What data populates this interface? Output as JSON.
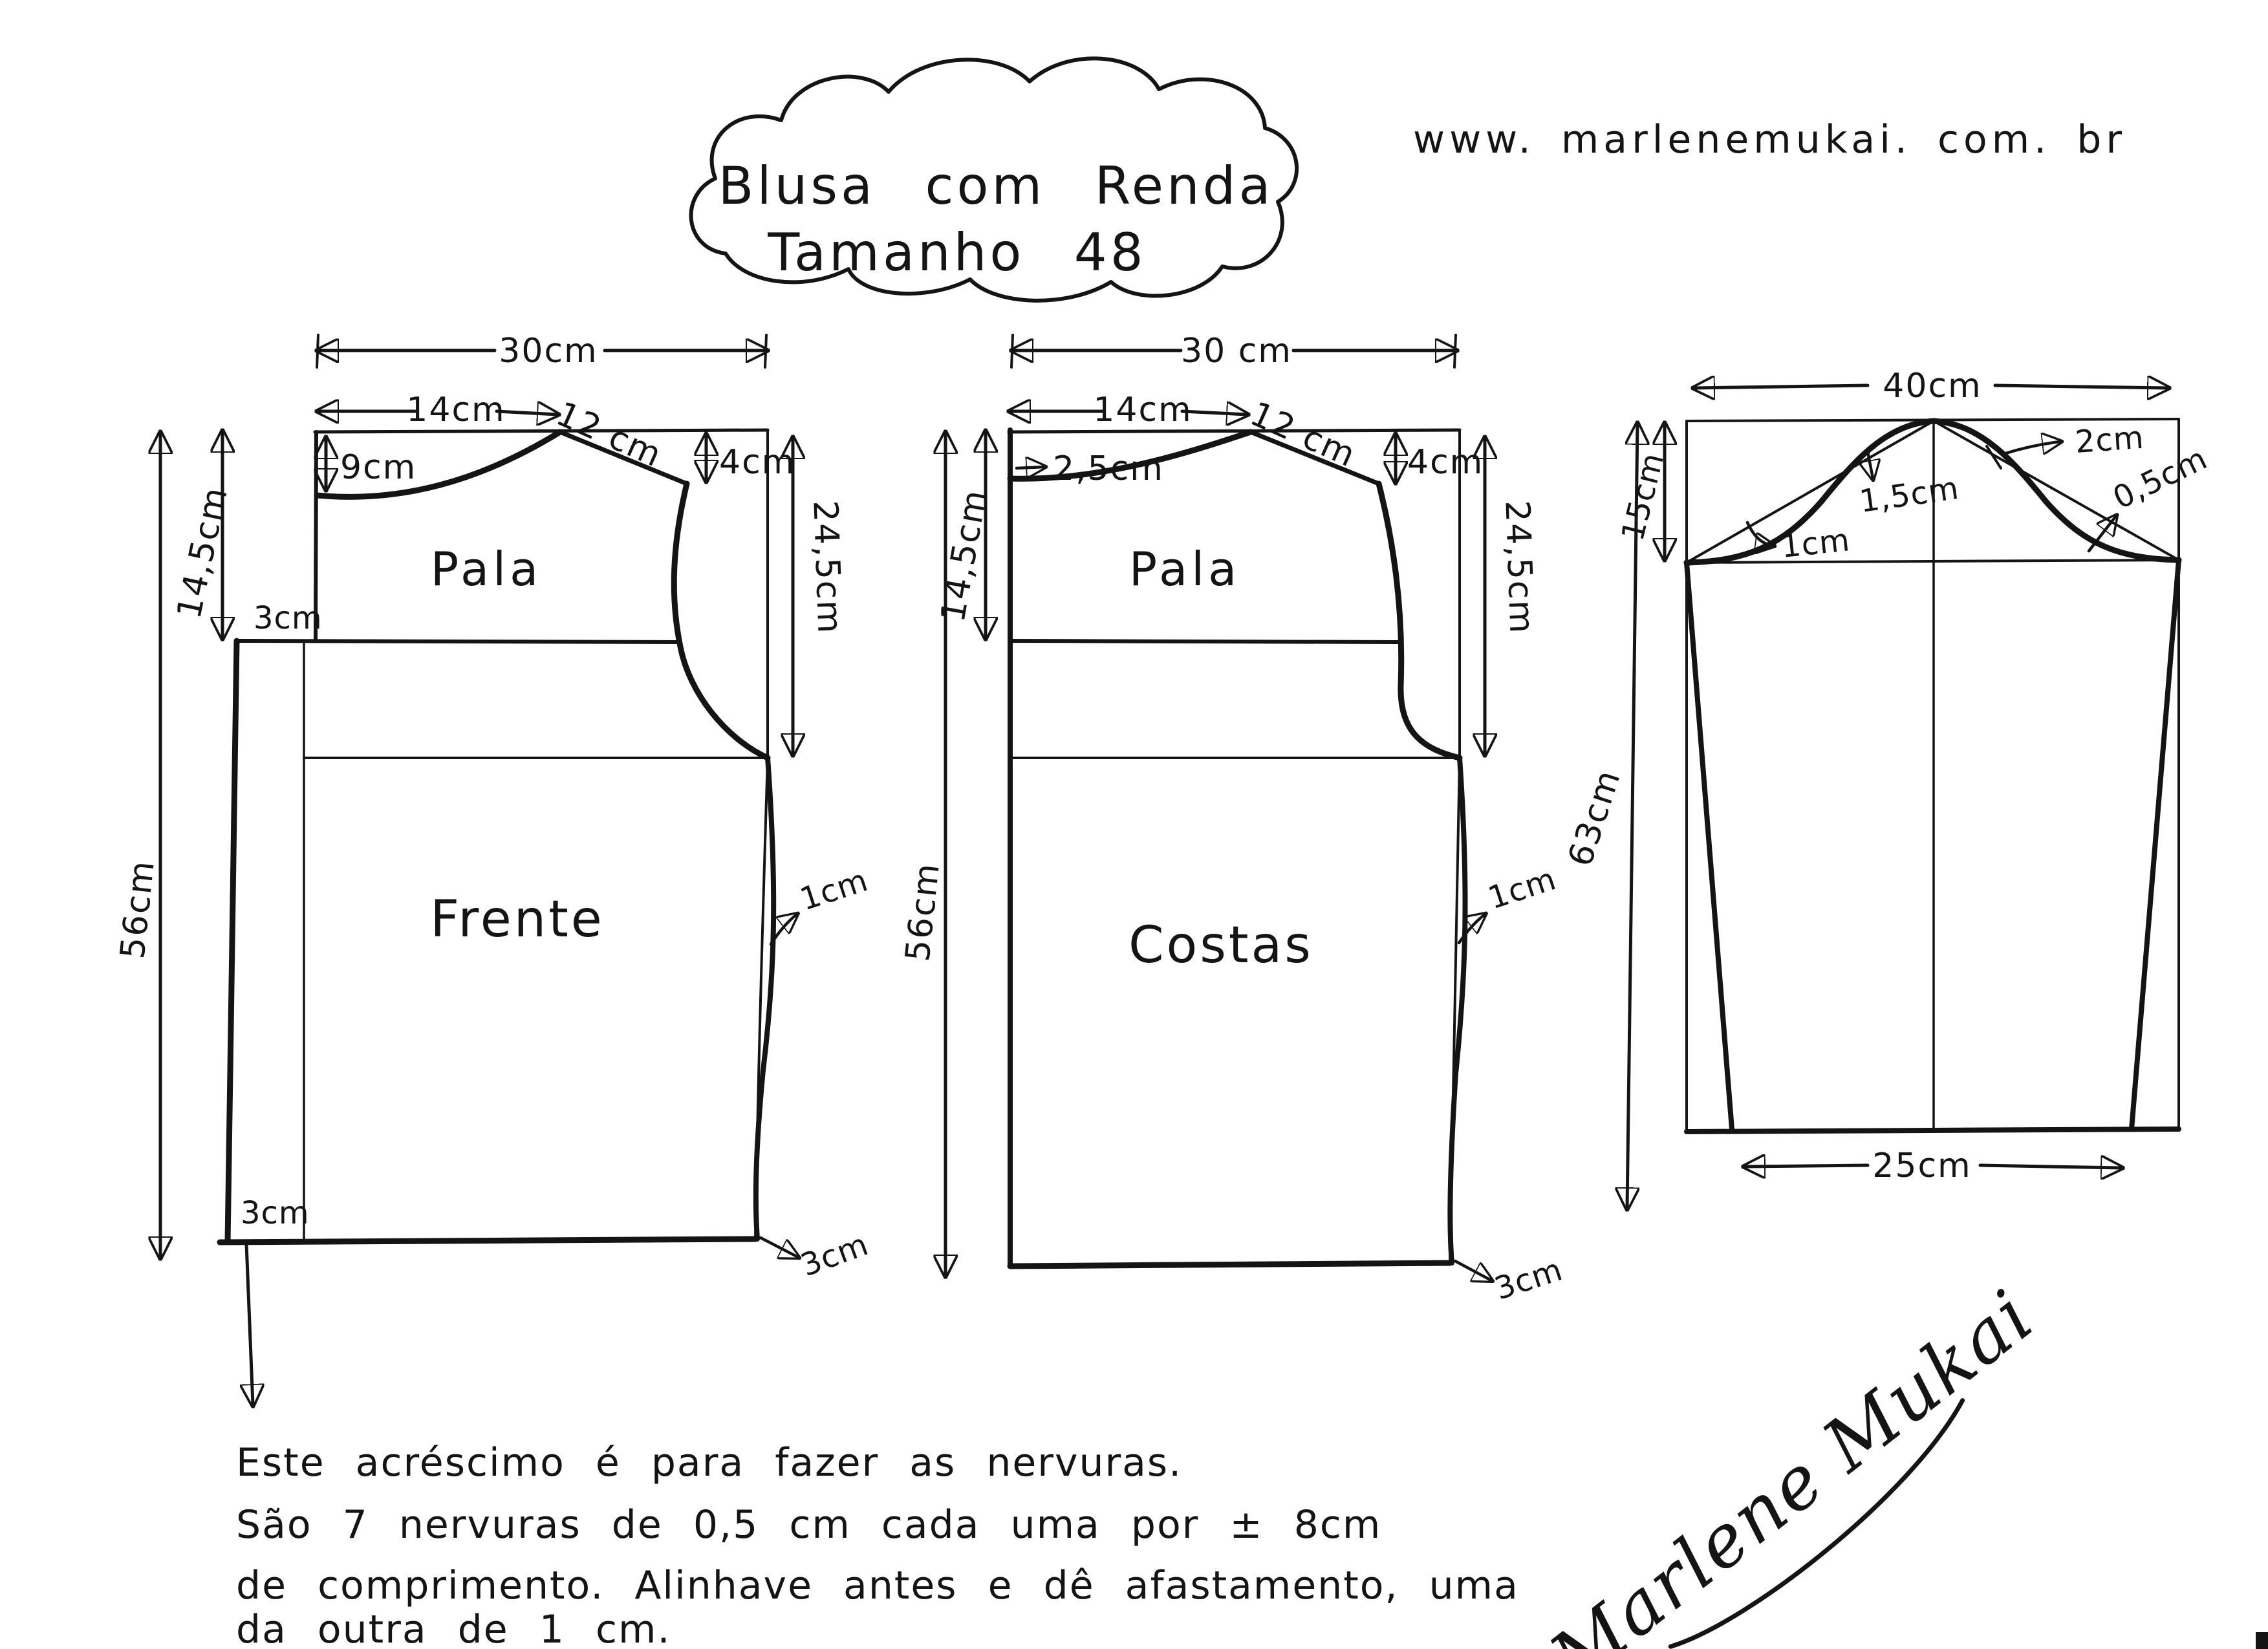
{
  "title": {
    "line1": "Blusa com Renda",
    "line2": "Tamanho 48"
  },
  "website": "www. marlenemukai. com. br",
  "front": {
    "piece_label": "Frente",
    "yoke_label": "Pala",
    "width_label": "30cm",
    "neck_width_label": "14cm",
    "neck_depth_label": "9cm",
    "shoulder_label": "12 cm",
    "shoulder_drop_label": "4cm",
    "yoke_height_label": "14,5cm",
    "yoke_offset_label": "3cm",
    "length_label": "56cm",
    "armhole_label": "24,5cm",
    "side_curve_label": "1cm",
    "hem_left_label": "3cm",
    "hem_right_label": "3cm"
  },
  "back": {
    "piece_label": "Costas",
    "yoke_label": "Pala",
    "width_label": "30 cm",
    "neck_width_label": "14cm",
    "neck_depth_label": "2,5cm",
    "shoulder_label": "12 cm",
    "shoulder_drop_label": "4cm",
    "yoke_height_label": "14,5cm",
    "length_label": "56cm",
    "armhole_label": "24,5cm",
    "side_curve_label": "1cm",
    "hem_right_label": "3cm"
  },
  "sleeve": {
    "width_label": "40cm",
    "cap_height_label": "15cm",
    "length_label": "63cm",
    "hem_width_label": "25cm",
    "front_notch_label": "1cm",
    "front_ease_label": "1,5cm",
    "back_ease_label": "2cm",
    "back_notch_label": "0,5cm"
  },
  "notes": [
    "Este acréscimo é para fazer as nervuras.",
    "São 7 nervuras de 0,5 cm cada uma por ± 8cm",
    "de comprimento. Alinhave antes e dê afastamento, uma",
    "da outra de 1 cm."
  ],
  "signature": "Marlene Mukai",
  "colors": {
    "ink": "#141414",
    "paper": "#ffffff"
  }
}
